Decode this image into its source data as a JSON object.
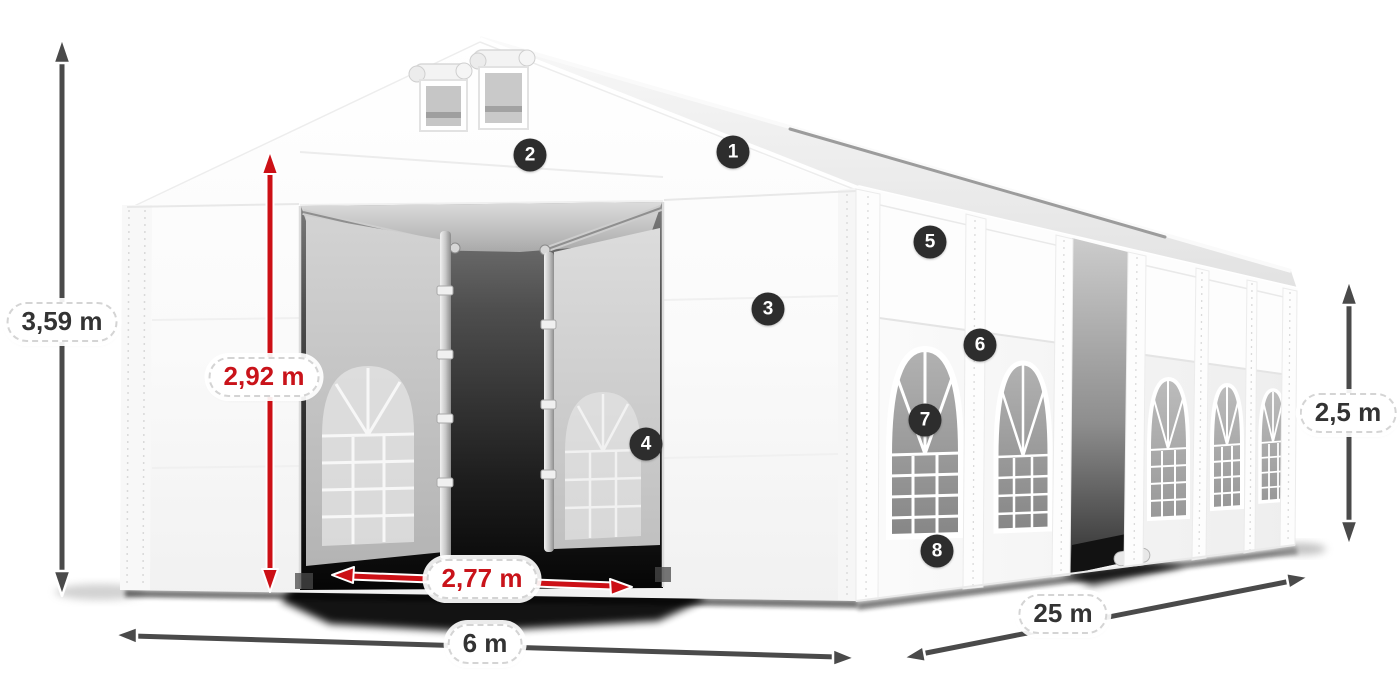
{
  "diagram_type": "tent-dimensions-diagram",
  "dimensions": {
    "total_height": {
      "label": "3,59 m",
      "style": "dark",
      "icon": "double-arrow-vertical"
    },
    "entrance_height": {
      "label": "2,92 m",
      "style": "red",
      "icon": "double-arrow-vertical"
    },
    "entrance_width": {
      "label": "2,77 m",
      "style": "red",
      "icon": "double-arrow-horizontal"
    },
    "gable_width": {
      "label": "6 m",
      "style": "dark",
      "icon": "double-arrow-horizontal"
    },
    "length": {
      "label": "25 m",
      "style": "dark",
      "icon": "double-arrow-diagonal"
    },
    "side_height": {
      "label": "2,5 m",
      "style": "dark",
      "icon": "double-arrow-vertical"
    }
  },
  "markers": [
    {
      "label": "1"
    },
    {
      "label": "2"
    },
    {
      "label": "3"
    },
    {
      "label": "4"
    },
    {
      "label": "5"
    },
    {
      "label": "6"
    },
    {
      "label": "7"
    },
    {
      "label": "8"
    }
  ],
  "colors": {
    "background": "#ffffff",
    "dimension_arrow_dark": "#4a4a4a",
    "dimension_arrow_red": "#cc1016",
    "dimension_text_dark": "#333333",
    "dimension_text_red": "#c9131a",
    "marker_background": "#2d2d2d",
    "marker_text": "#ffffff",
    "tent_fabric": "#ffffff"
  }
}
